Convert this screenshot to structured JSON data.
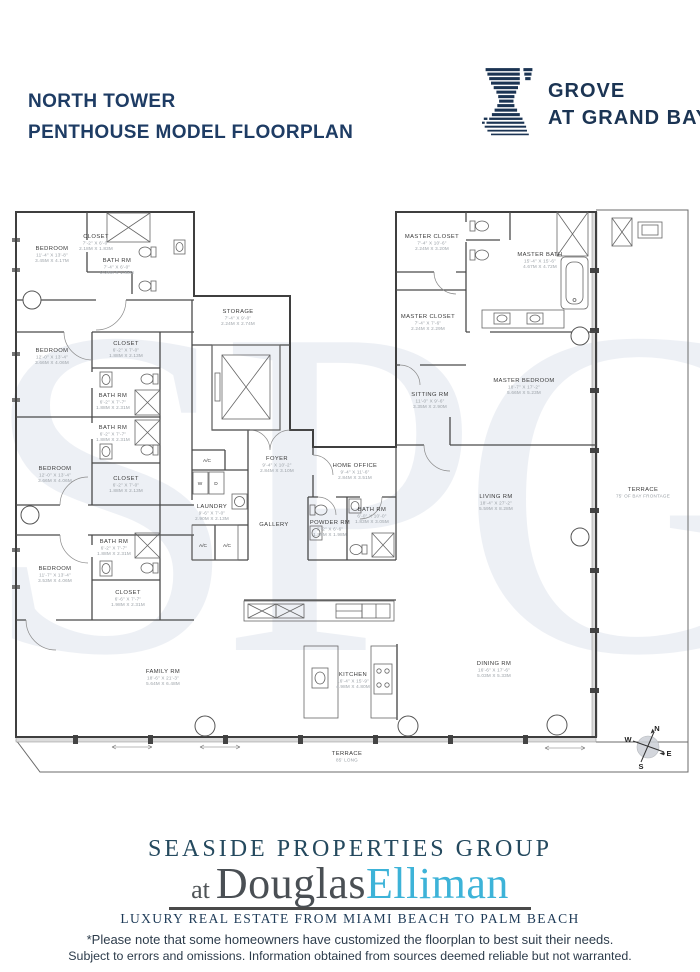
{
  "header": {
    "title_line1": "NORTH TOWER",
    "title_line2": "PENTHOUSE MODEL FLOORPLAN",
    "logo_line1": "GROVE",
    "logo_line2": "AT GRAND BAY"
  },
  "watermark": "SPG",
  "floorplan": {
    "rooms": [
      {
        "name": "BEDROOM",
        "dim1": "11'-4\" X 13'-8\"",
        "dim2": "3.45M X 4.17M",
        "x": 52,
        "y": 250
      },
      {
        "name": "CLOSET",
        "dim1": "7'-2\" X 6'-0\"",
        "dim2": "2.18M X 1.83M",
        "x": 96,
        "y": 238
      },
      {
        "name": "BATH RM",
        "dim1": "7'-4\" X 6'-0\"",
        "dim2": "2.24M X 1.83M",
        "x": 117,
        "y": 262
      },
      {
        "name": "BEDROOM",
        "dim1": "12'-0\" X 13'-4\"",
        "dim2": "3.66M X 4.06M",
        "x": 52,
        "y": 352
      },
      {
        "name": "CLOSET",
        "dim1": "6'-2\" X 7'-0\"",
        "dim2": "1.88M X 2.13M",
        "x": 126,
        "y": 345
      },
      {
        "name": "BATH RM",
        "dim1": "6'-2\" X 7'-7\"",
        "dim2": "1.88M X 2.31M",
        "x": 113,
        "y": 397
      },
      {
        "name": "BATH RM",
        "dim1": "6'-2\" X 7'-7\"",
        "dim2": "1.88M X 2.31M",
        "x": 113,
        "y": 429
      },
      {
        "name": "BEDROOM",
        "dim1": "12'-0\" X 13'-4\"",
        "dim2": "3.66M X 4.06M",
        "x": 55,
        "y": 470
      },
      {
        "name": "CLOSET",
        "dim1": "6'-2\" X 7'-0\"",
        "dim2": "1.88M X 2.13M",
        "x": 126,
        "y": 480
      },
      {
        "name": "BATH RM",
        "dim1": "6'-2\" X 7'-7\"",
        "dim2": "1.88M X 2.31M",
        "x": 114,
        "y": 543
      },
      {
        "name": "BEDROOM",
        "dim1": "11'-7\" X 13'-4\"",
        "dim2": "3.53M X 4.06M",
        "x": 55,
        "y": 570
      },
      {
        "name": "CLOSET",
        "dim1": "6'-6\" X 7'-7\"",
        "dim2": "1.98M X 2.31M",
        "x": 128,
        "y": 594
      },
      {
        "name": "STORAGE",
        "dim1": "7'-4\" X 9'-0\"",
        "dim2": "2.24M X 2.74M",
        "x": 238,
        "y": 313
      },
      {
        "name": "FOYER",
        "dim1": "9'-4\" X 10'-2\"",
        "dim2": "2.84M X 3.10M",
        "x": 277,
        "y": 460
      },
      {
        "name": "HOME OFFICE",
        "dim1": "9'-4\" X 11'-6\"",
        "dim2": "2.84M X 3.51M",
        "x": 355,
        "y": 467
      },
      {
        "name": "LAUNDRY",
        "dim1": "9'-6\" X 7'-0\"",
        "dim2": "2.90M X 2.13M",
        "x": 212,
        "y": 508
      },
      {
        "name": "GALLERY",
        "dim1": null,
        "dim2": null,
        "x": 274,
        "y": 526
      },
      {
        "name": "POWDER RM",
        "dim1": "6'-2\" X 6'-6\"",
        "dim2": "1.88M X 1.98M",
        "x": 330,
        "y": 524
      },
      {
        "name": "BATH RM",
        "dim1": "6'-0\" X 10'-0\"",
        "dim2": "1.83M X 3.05M",
        "x": 372,
        "y": 511
      },
      {
        "name": "MASTER CLOSET",
        "dim1": "7'-4\" X 10'-6\"",
        "dim2": "2.24M X 3.20M",
        "x": 432,
        "y": 238
      },
      {
        "name": "MASTER CLOSET",
        "dim1": "7'-4\" X 7'-6\"",
        "dim2": "2.24M X 2.29M",
        "x": 428,
        "y": 318
      },
      {
        "name": "MASTER BATH",
        "dim1": "15'-4\" X 15'-6\"",
        "dim2": "4.67M X 4.72M",
        "x": 540,
        "y": 256
      },
      {
        "name": "SITTING RM",
        "dim1": "11'-0\" X 9'-6\"",
        "dim2": "3.35M X 2.90M",
        "x": 430,
        "y": 396
      },
      {
        "name": "MASTER BEDROOM",
        "dim1": "18'-7\" X 17'-2\"",
        "dim2": "5.66M X 5.23M",
        "x": 524,
        "y": 382
      },
      {
        "name": "LIVING RM",
        "dim1": "18'-4\" X 27'-2\"",
        "dim2": "5.59M X 8.28M",
        "x": 496,
        "y": 498
      },
      {
        "name": "DINING RM",
        "dim1": "16'-6\" X 17'-6\"",
        "dim2": "5.03M X 5.33M",
        "x": 494,
        "y": 665
      },
      {
        "name": "FAMILY RM",
        "dim1": "18'-6\" X 21'-3\"",
        "dim2": "5.64M X 6.48M",
        "x": 163,
        "y": 673
      },
      {
        "name": "KITCHEN",
        "dim1": "16'-4\" X 15'-9\"",
        "dim2": "4.98M X 4.80M",
        "x": 353,
        "y": 676
      },
      {
        "name": "TERRACE",
        "dim1": "75' OF BAY FRONTAGE",
        "dim2": null,
        "x": 643,
        "y": 491
      },
      {
        "name": "TERRACE",
        "dim1": "85' LONG",
        "dim2": null,
        "x": 347,
        "y": 755
      }
    ],
    "small_labels": [
      {
        "t": "A/C",
        "x": 207,
        "y": 462,
        "c": "tiny-label"
      },
      {
        "t": "A/C",
        "x": 203,
        "y": 547,
        "c": "tiny-label"
      },
      {
        "t": "A/C",
        "x": 227,
        "y": 547,
        "c": "tiny-label"
      },
      {
        "t": "W",
        "x": 200,
        "y": 485,
        "c": "tiny-label"
      },
      {
        "t": "D",
        "x": 216,
        "y": 485,
        "c": "tiny-label"
      },
      {
        "t": "N",
        "x": 657,
        "y": 731,
        "c": "compass-letter"
      },
      {
        "t": "E",
        "x": 669,
        "y": 756,
        "c": "compass-letter"
      },
      {
        "t": "S",
        "x": 641,
        "y": 769,
        "c": "compass-letter"
      },
      {
        "t": "W",
        "x": 628,
        "y": 742,
        "c": "compass-letter"
      }
    ]
  },
  "footer": {
    "brand_line1": "SEASIDE PROPERTIES GROUP",
    "brand_at": "at",
    "brand_name1": "Douglas",
    "brand_name2": "Elliman",
    "tagline": "LUXURY REAL ESTATE FROM MIAMI BEACH TO PALM BEACH",
    "disclaimer_line1": "*Please note that some homeowners have customized the floorplan to best suit their needs.",
    "disclaimer_line2": "Subject to errors and omissions. Information obtained from sources deemed reliable but not warranted."
  },
  "colors": {
    "navy": "#1e3c64",
    "logo_navy": "#1b3453",
    "elliman_blue": "#3db3d8",
    "brand_teal": "#24495e",
    "watermark": "#2a4d86",
    "plan_line": "#4a4a4a"
  }
}
